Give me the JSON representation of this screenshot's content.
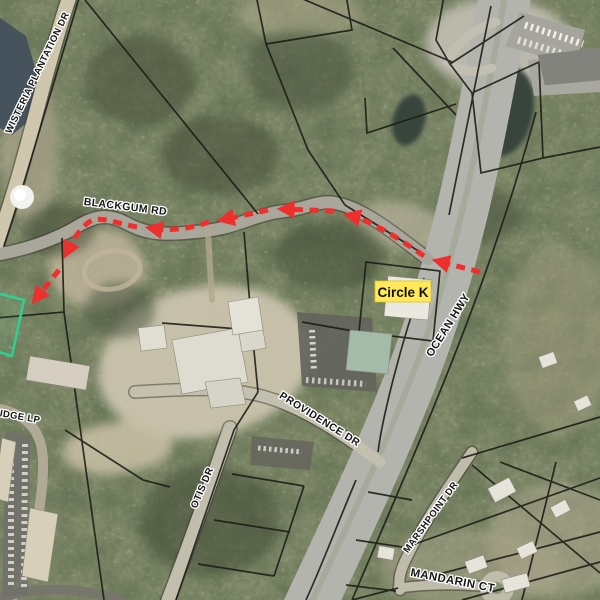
{
  "map": {
    "road_labels": [
      {
        "id": "wisteria",
        "text": "WISTERIA PLANTATION DR"
      },
      {
        "id": "blackgum",
        "text": "BLACKGUM RD"
      },
      {
        "id": "ocean-hwy",
        "text": "OCEAN HWY"
      },
      {
        "id": "providence",
        "text": "PROVIDENCE DR"
      },
      {
        "id": "otis",
        "text": "OTIS DR"
      },
      {
        "id": "marshpoint",
        "text": "MARSHPOINT DR"
      },
      {
        "id": "mandarin",
        "text": "MANDARIN CT"
      },
      {
        "id": "ridge",
        "text": "RIDGE LP"
      }
    ],
    "poi_label": {
      "text": "Circle K",
      "bg_color": "#FFE95A",
      "text_color": "#111111"
    },
    "route": {
      "color": "#EF2E2E",
      "style": "dashed-with-arrowheads",
      "from": "Ocean Hwy",
      "along": "Blackgum Rd",
      "to": "highlighted parcel (southwest)"
    },
    "colors": {
      "parcel_line": "#1B1B15",
      "highlight_parcel": "#2FCF8F",
      "route_red": "#EF2E2E",
      "label_halo": "#FFFFFF"
    }
  }
}
